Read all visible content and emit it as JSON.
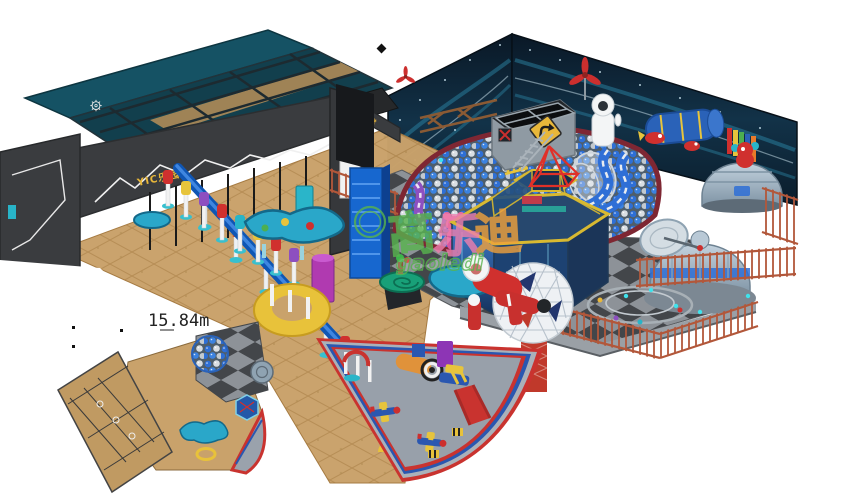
{
  "gate": {
    "sign": "YIC乐园",
    "beam_sign": "运动殿堂"
  },
  "watermark": {
    "cn": "高乐迪",
    "chars": [
      "高",
      "乐",
      "迪"
    ],
    "en": "gaoledi"
  },
  "inset": {
    "dimension_label": "15.84m"
  },
  "palette": {
    "background": "#ffffff",
    "wall_navy": "#0e2233",
    "wall_streak_teal": "#2f8fb0",
    "gate_gray": "#3a3c3f",
    "roof_teal": "#155264",
    "floor_tan": "#c9a26b",
    "checker_dark": "#43464a",
    "checker_light": "#8d9298",
    "ball_blue": "#2e6fd6",
    "ball_silver": "#d9dee3",
    "pit_rim_maroon": "#7e2733",
    "accent_red": "#cc2f2e",
    "fence_orange": "#b2573a",
    "rail_blue": "#0f56b4",
    "dome_gray": "#a8bac9",
    "trim_yellow": "#e7c43c",
    "glass_blue": "#2b5fae",
    "teal": "#28b4c8",
    "purple": "#8d4fc0",
    "magenta": "#c03a8e",
    "toddler_floor": "#98a0aa",
    "sign_yellow": "#e8b73a",
    "watermark_green": "#58b44e",
    "watermark_pink": "#ef7fae",
    "watermark_orange": "#f2a23c"
  },
  "objects": [
    "entrance-gate",
    "gear-band",
    "space-wall-left",
    "space-wall-right",
    "sand-floor",
    "checker-floor",
    "ball-pit",
    "cube-tower",
    "turn-sign",
    "propeller",
    "astronaut-robot",
    "blue-tunnel",
    "red-alien",
    "space-dome-small",
    "space-dome-large",
    "radar-dish",
    "carousel-platform",
    "safety-fence",
    "wooden-fence",
    "geodesic-sphere",
    "hex-capsule",
    "red-pyramid-cap",
    "wave-slide",
    "purple-slide",
    "zipline-rail",
    "stair-tower",
    "play-table",
    "yellow-planter",
    "spiral-pedestal",
    "astronaut-lying",
    "telescope",
    "toddler-soft-play-area",
    "foam-train",
    "foam-plane",
    "toddler-slide",
    "arch-gate",
    "floor-plan-inset"
  ]
}
